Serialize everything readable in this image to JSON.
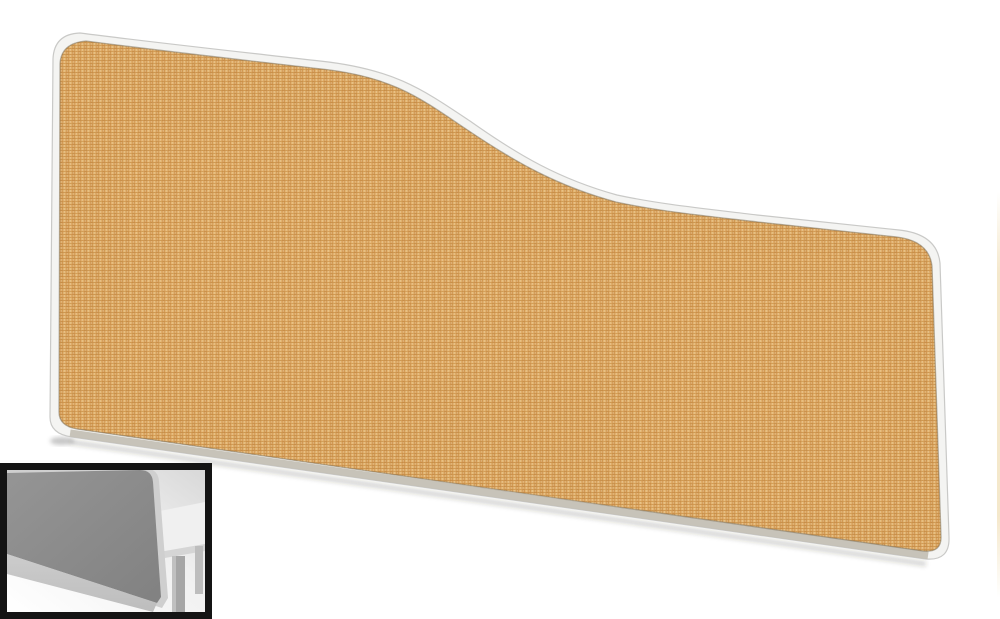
{
  "page": {
    "kind": "product-photo",
    "background": "#ffffff"
  },
  "main_image": {
    "subject": "wave-top-desk-screen",
    "fabric": "beige-woven-upholstery",
    "frame": "white-rounded-trim"
  },
  "thumbnail": {
    "subject": "desk-screen-mounted-on-desk",
    "style": "greyscale-render",
    "position": "bottom-left"
  },
  "colors": {
    "fabric_base": "#dfa35a",
    "fabric_col_dark": "#d2924a",
    "fabric_col_light": "#e7b068",
    "fabric_weft": "#c08238",
    "fabric_knot_a": "#f2cd92",
    "fabric_knot_b": "#f5d69e",
    "fabric_fleck": "#f9e9c4",
    "frame_white": "#f4f4f2",
    "frame_edge": "#c6c6c4",
    "frame_shadow": "#c2beb2",
    "under_shadow": "#6b5d42",
    "thumb_border": "#141414",
    "thumb_screen": "#8c8c8c",
    "thumb_screen_trim": "#cfcfcf",
    "thumb_band": "#bdbdbd",
    "thumb_desk": "#f0f0f0",
    "thumb_desk_edge": "#d5d5d5",
    "thumb_leg": "#a6a6a6",
    "thumb_bg_dark": "#d8d8d8",
    "sliver": "#f1e0ba"
  }
}
